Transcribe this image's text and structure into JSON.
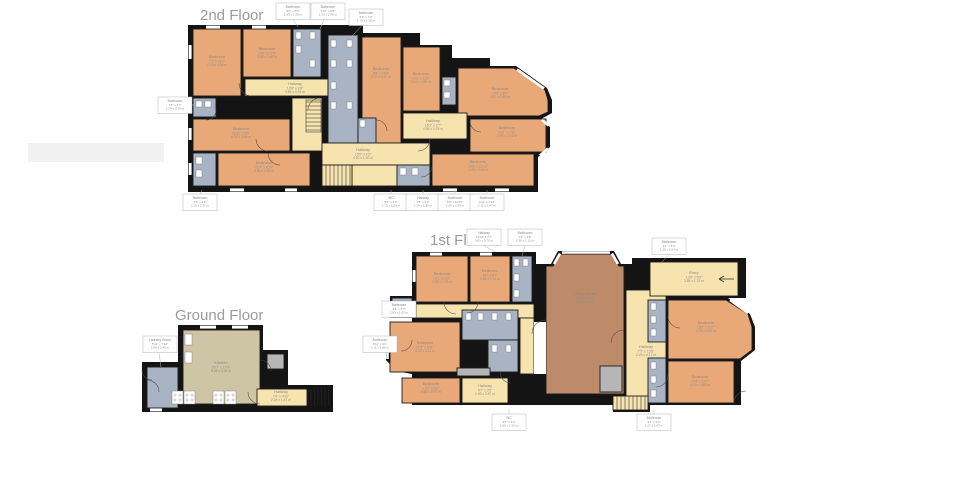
{
  "page": {
    "background": "#ffffff"
  },
  "palette": {
    "wall": "#141414",
    "bedroom": "#e9a877",
    "hallway": "#f6e3ae",
    "bathroom": "#a8b3c4",
    "living_room": "#bd8a6a",
    "kitchen": "#cdc5a4",
    "closet_gray": "#b6b6b6",
    "label_text": "#8a8a8a",
    "title_text": "#9b9b9b",
    "label_box_border": "#b3b3b3"
  },
  "floors": {
    "second": {
      "title": "2nd Floor",
      "room_labels": [
        {
          "name": "Bedroom",
          "ft": "7'1\" x 14'1\"",
          "m": "2.16 x 4.29 m",
          "x": 217,
          "y": 58
        },
        {
          "name": "Bedroom",
          "ft": "10'8\" x 11'5\"",
          "m": "3.25 x 3.48 m",
          "x": 267,
          "y": 50
        },
        {
          "name": "Hallway",
          "ft": "12'8\" x 2'8\"",
          "m": "3.86 x 0.81 m",
          "x": 295,
          "y": 85
        },
        {
          "name": "Bedroom",
          "ft": "22'11\" x 8'6\"",
          "m": "6.99 x 2.59 m",
          "x": 241,
          "y": 130
        },
        {
          "name": "Bedroom",
          "ft": "21'4\" x 8'10\"",
          "m": "6.50 x 2.69 m",
          "x": 264,
          "y": 164
        },
        {
          "name": "Bedroom",
          "ft": "9'9\" x 16'9\"",
          "m": "2.97 x 5.11 m",
          "x": 381,
          "y": 70
        },
        {
          "name": "Bedroom",
          "ft": "10'2\" x 15'9\"",
          "m": "3.10 x 4.80 m",
          "x": 421,
          "y": 75
        },
        {
          "name": "Bedroom",
          "ft": "15'0\" x 8'1\"",
          "m": "4.57 x 2.46 m",
          "x": 500,
          "y": 90
        },
        {
          "name": "Hallway",
          "ft": "16'3\" x 2'7\"",
          "m": "4.95 x 0.79 m",
          "x": 433,
          "y": 122
        },
        {
          "name": "Bedroom",
          "ft": "13'1\" x 7'11\"",
          "m": "3.99 x 2.41 m",
          "x": 507,
          "y": 129
        },
        {
          "name": "Hallway",
          "ft": "15'9\" x 4'3\"",
          "m": "4.80 x 1.30 m",
          "x": 363,
          "y": 151
        },
        {
          "name": "Bedroom",
          "ft": "15'8\" x 11'10\"",
          "m": "4.78 x 3.61 m",
          "x": 478,
          "y": 163
        }
      ],
      "ext_labels": [
        {
          "name": "Bathroom",
          "ft": "6'0\" x 5'6\"",
          "m": "1.83 x 1.68 m",
          "x": 276,
          "y": 3,
          "leader": [
            293,
            19.5,
            298,
            27
          ]
        },
        {
          "name": "Bathroom",
          "ft": "4'11\" x 6'9\"",
          "m": "1.50 x 2.06 m",
          "x": 311,
          "y": 3,
          "leader": [
            324,
            19.5,
            320,
            29
          ]
        },
        {
          "name": "Bathroom",
          "ft": "5'9\" x 7'2\"",
          "m": "1.75 x 2.18 m",
          "x": 349,
          "y": 9,
          "leader": [
            362,
            25.5,
            352,
            36
          ]
        },
        {
          "name": "Bathroom",
          "ft": "7'4\" x 2'7\"",
          "m": "2.24 x 0.79 m",
          "x": 158,
          "y": 97,
          "leader": [
            192,
            105,
            195,
            105
          ]
        },
        {
          "name": "Bathroom",
          "ft": "7'6\" x 4'6\"",
          "m": "2.29 x 1.37 m",
          "x": 183,
          "y": 194,
          "leader": [
            200,
            194,
            202,
            190
          ]
        },
        {
          "name": "WC",
          "ft": "5'8\" x 4'2\"",
          "m": "1.72 x 1.26 m",
          "x": 374,
          "y": 194,
          "leader": [
            391,
            194,
            391,
            190
          ]
        },
        {
          "name": "Hallway",
          "ft": "4'5\" x 4'4\"",
          "m": "1.35 x 1.32 m",
          "x": 406,
          "y": 194,
          "leader": [
            423,
            194,
            423,
            190
          ]
        },
        {
          "name": "Bathroom",
          "ft": "6'9\" x 10'10\"",
          "m": "2.06 x 3.30 m",
          "x": 438,
          "y": 194,
          "leader": [
            455,
            194,
            455,
            190
          ]
        },
        {
          "name": "Bathroom",
          "ft": "6'11\" x 4'10\"",
          "m": "2.11 x 1.47 m",
          "x": 470,
          "y": 194,
          "leader": [
            487,
            194,
            487,
            190
          ]
        }
      ]
    },
    "first": {
      "title": "1st Floor",
      "room_labels": [
        {
          "name": "Bedroom",
          "ft": "11'1\" x 7'9\"",
          "m": "3.38 x 2.36 m",
          "x": 442,
          "y": 275
        },
        {
          "name": "Bedroom",
          "ft": "8'8\" x 6'7\"",
          "m": "2.64 x 2.01 m",
          "x": 490,
          "y": 272
        },
        {
          "name": "Living Room",
          "ft": "16'7\" x 18'9\"",
          "m": "5.05 x 5.72 m",
          "x": 585,
          "y": 295
        },
        {
          "name": "Entry",
          "ft": "12'8\" x 5'9\"",
          "m": "3.86 x 1.75 m",
          "x": 694,
          "y": 274
        },
        {
          "name": "Bedroom",
          "ft": "17'2\" x 6'11\"",
          "m": "5.23 x 2.11 m",
          "x": 425,
          "y": 344
        },
        {
          "name": "Bedroom",
          "ft": "15'8\" x 10'7\"",
          "m": "4.78 x 3.23 m",
          "x": 706,
          "y": 324
        },
        {
          "name": "Hallway",
          "ft": "7'5\" x 13'8\"",
          "m": "2.26 x 4.17 m",
          "x": 646,
          "y": 348
        },
        {
          "name": "Bedroom",
          "ft": "12'1\" x 9'9\"",
          "m": "3.68 x 2.97 m",
          "x": 431,
          "y": 385
        },
        {
          "name": "Hallway",
          "ft": "4'7\" x 9'5\"",
          "m": "1.40 x 2.87 m",
          "x": 485,
          "y": 387
        },
        {
          "name": "Bedroom",
          "ft": "13'9\" x 11'7\"",
          "m": "4.19 x 3.53 m",
          "x": 700,
          "y": 378
        }
      ],
      "ext_labels": [
        {
          "name": "Hallway",
          "ft": "11'10\" x 2'7\"",
          "m": "3.61 x 0.79 m",
          "x": 467,
          "y": 229,
          "leader": [
            484,
            245.5,
            495,
            252
          ]
        },
        {
          "name": "Bathroom",
          "ft": "7'9\" x 3'8\"",
          "m": "2.36 x 1.12 m",
          "x": 508,
          "y": 229,
          "leader": [
            525,
            245.5,
            522,
            256
          ]
        },
        {
          "name": "Bathroom",
          "ft": "4'1\" x 8'4\"",
          "m": "1.25 x 2.54 m",
          "x": 652,
          "y": 238,
          "leader": [
            669,
            254.5,
            662,
            262
          ]
        },
        {
          "name": "Bathroom",
          "ft": "9'8\" x 5'4\"",
          "m": "2.95 x 1.63 m",
          "x": 382,
          "y": 301,
          "leader": null
        },
        {
          "name": "Bathroom",
          "ft": "6'11\" x 6'2\"",
          "m": "2.11 x 1.88 m",
          "x": 363,
          "y": 336,
          "leader": [
            397,
            344,
            402,
            344
          ]
        },
        {
          "name": "WC",
          "ft": "5'5\" x 4'4\"",
          "m": "1.65 x 1.32 m",
          "x": 492,
          "y": 414,
          "leader": [
            509,
            414,
            509,
            409
          ]
        },
        {
          "name": "Bathroom",
          "ft": "4'2\" x 6'4\"",
          "m": "1.27 x 1.93 m",
          "x": 637,
          "y": 414,
          "leader": [
            654,
            414,
            654,
            409
          ]
        }
      ]
    },
    "ground": {
      "title": "Ground Floor",
      "room_labels": [
        {
          "name": "Kitchen",
          "ft": "16'7\" x 17'4\"",
          "m": "5.05 x 5.28 m",
          "x": 221,
          "y": 364
        },
        {
          "name": "Hallway",
          "ft": "7'4\" x 4'10\"",
          "m": "2.24 x 1.47 m",
          "x": 281,
          "y": 393
        }
      ],
      "ext_labels": [
        {
          "name": "Laundry Room",
          "ft": "5'11\" x 7'10\"",
          "m": "1.80 x 2.40 m",
          "x": 143,
          "y": 336,
          "leader": [
            159,
            352.5,
            161,
            367
          ]
        }
      ]
    }
  }
}
